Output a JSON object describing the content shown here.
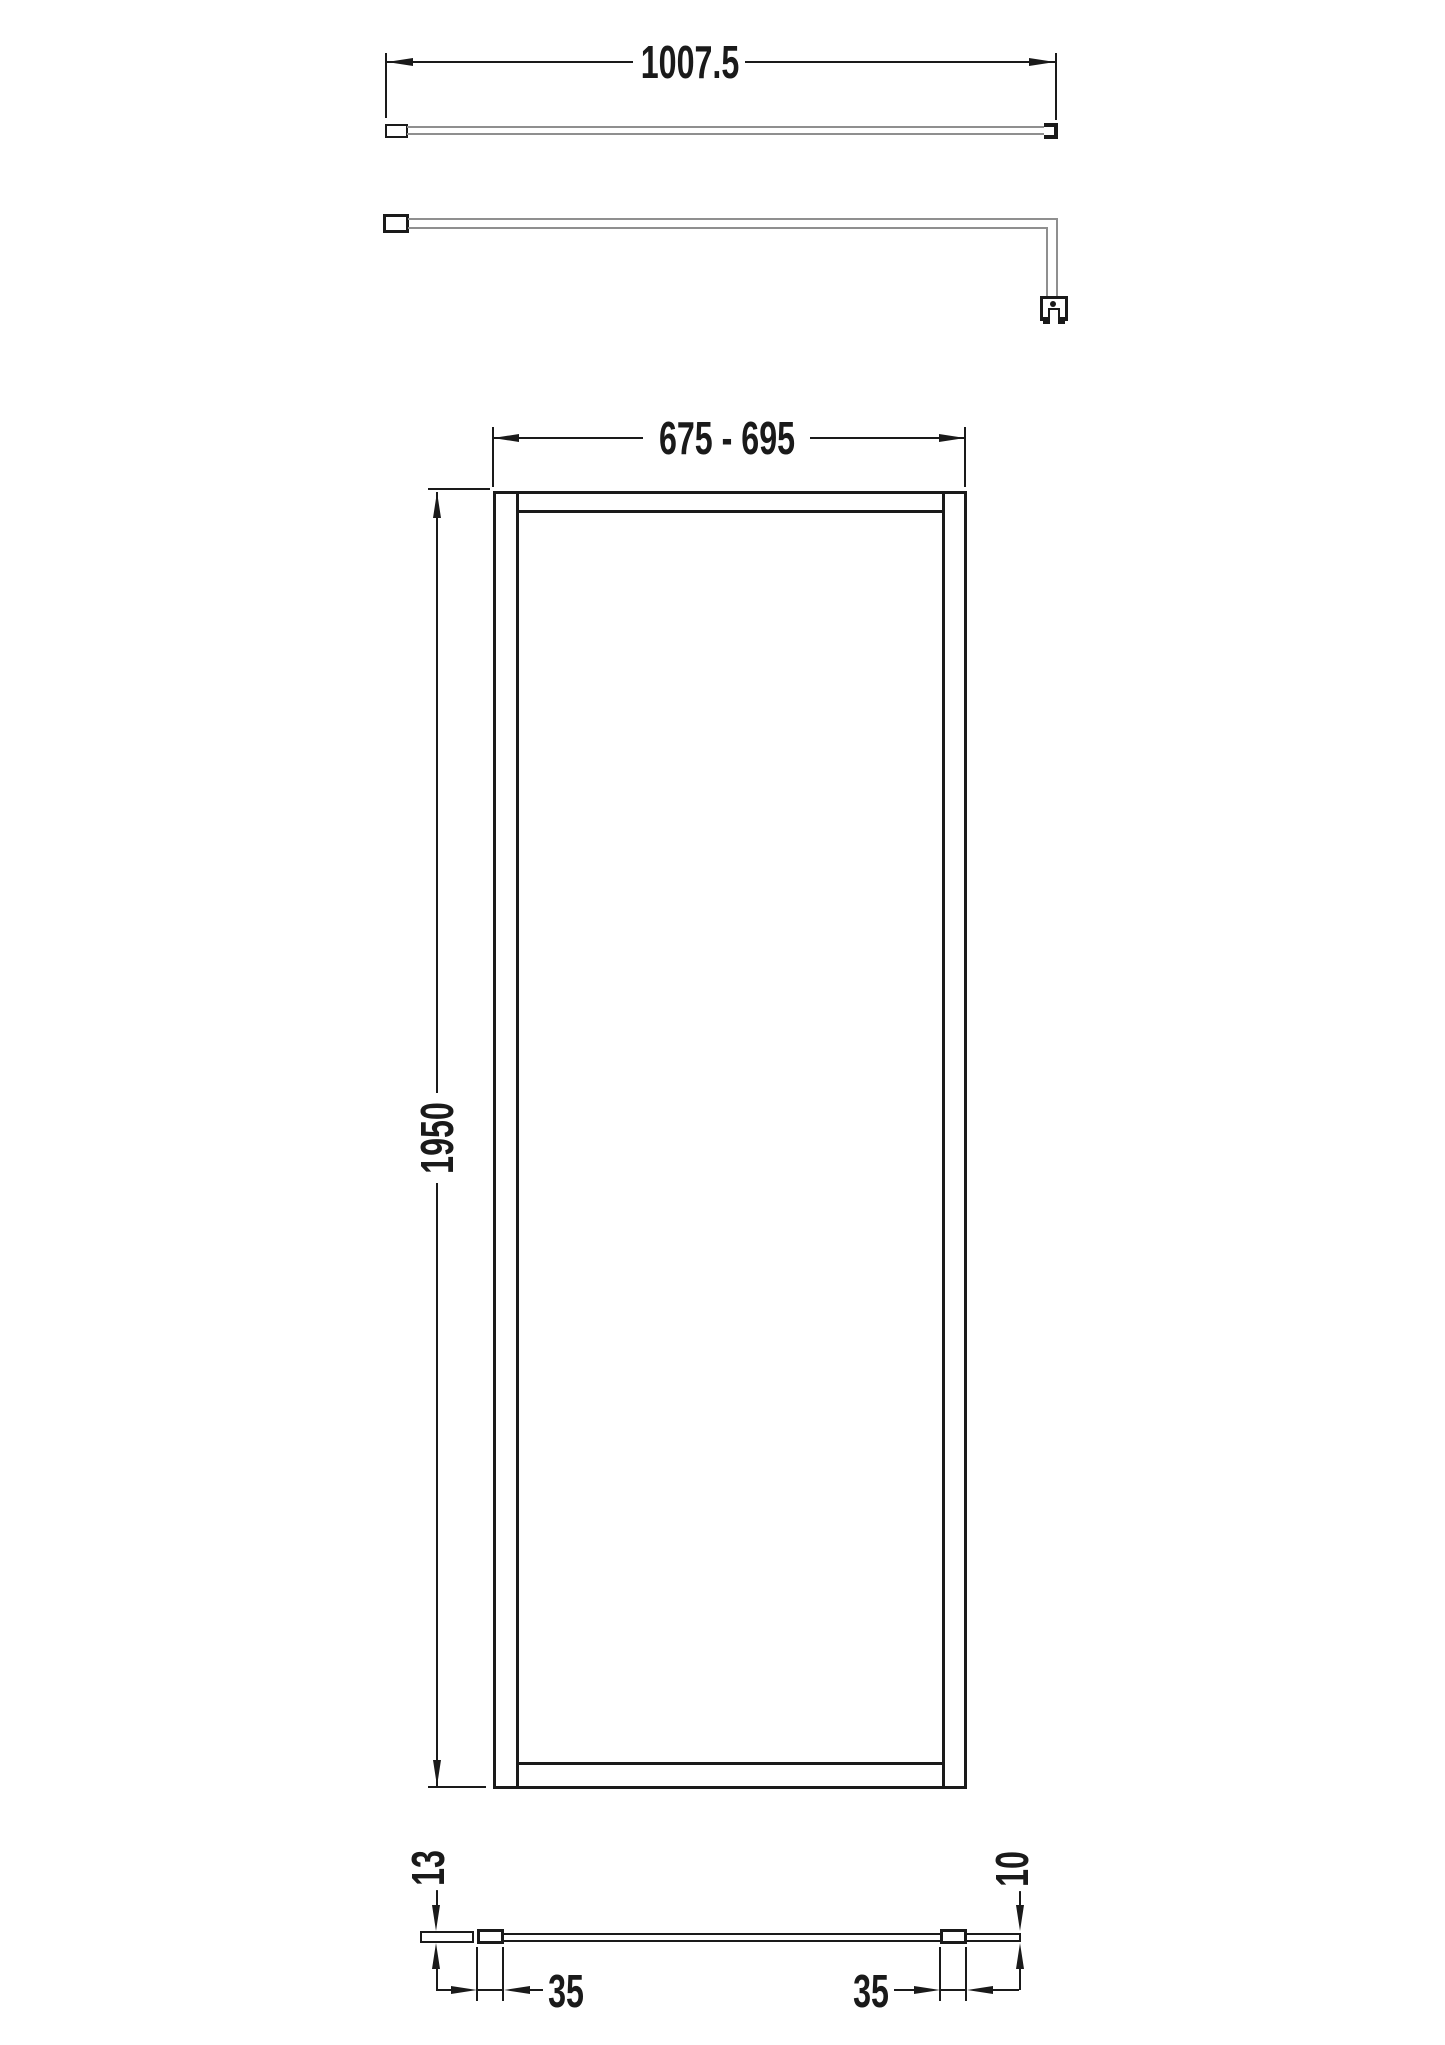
{
  "colors": {
    "line": "#1a1a1a",
    "tube_line": "#8f8f8f",
    "background": "#ffffff"
  },
  "dimensions": {
    "arm_length": "1007.5",
    "panel_width_range": "675 - 695",
    "panel_height": "1950",
    "wall_profile_thickness": "13",
    "glass_thickness": "10",
    "left_clamp_width": "35",
    "right_clamp_width": "35"
  }
}
